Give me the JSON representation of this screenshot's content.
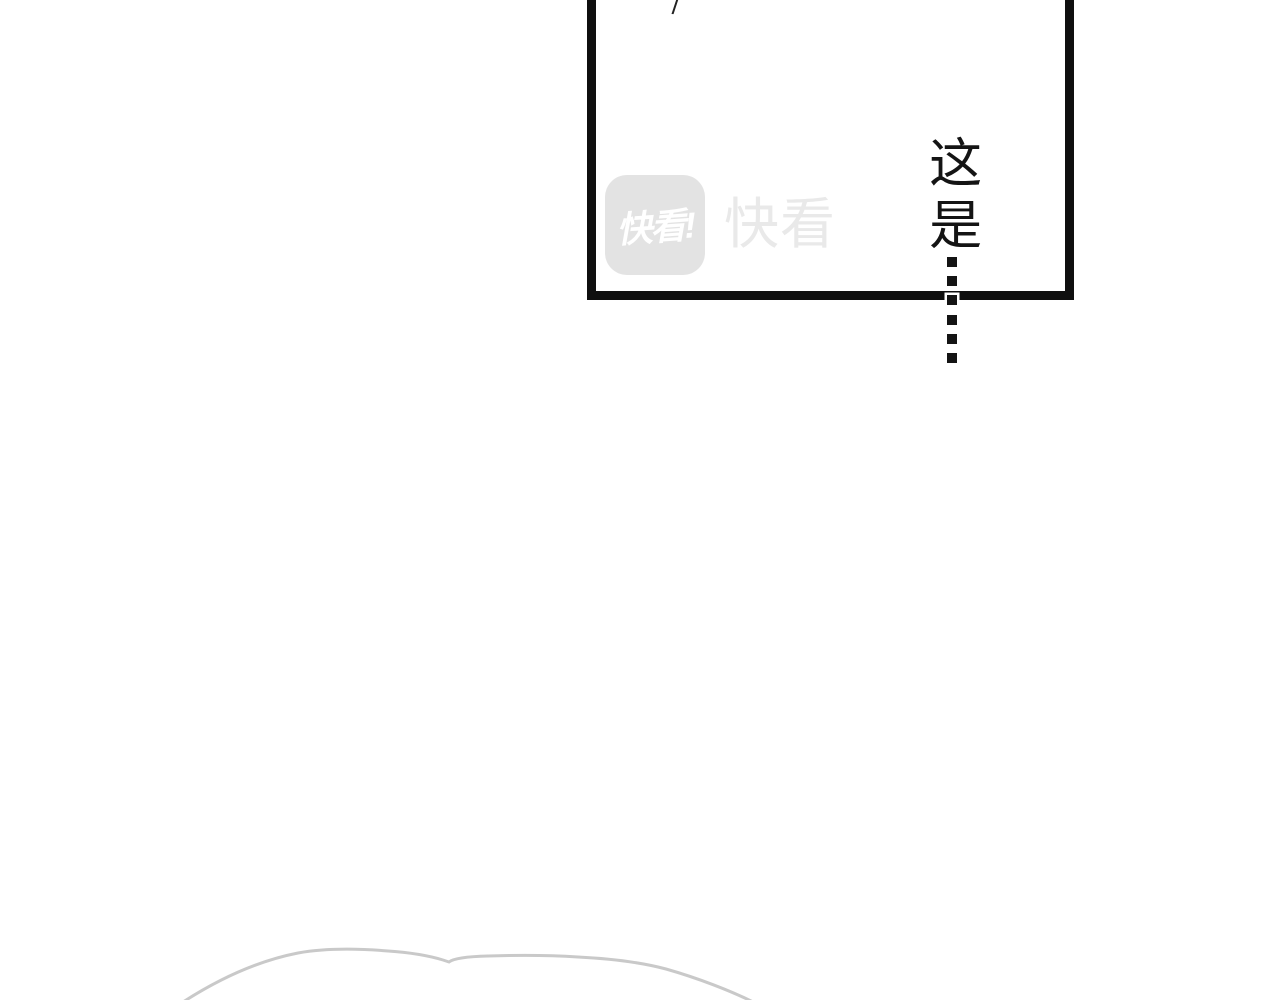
{
  "page": {
    "type": "comic-panel-page",
    "background": "#ffffff"
  },
  "panel": {
    "slash_mark": "/",
    "border_color": "#0f0f0f"
  },
  "watermark": {
    "logo_text": "快看!",
    "brand_text": "快看",
    "logo_badge_color": "#e3e3e3",
    "logo_text_color": "#ffffff",
    "brand_text_color": "#e9e9e9"
  },
  "speech": {
    "vertical_text": "这是",
    "text_color": "#141414"
  },
  "dotted_line": {
    "dash_count": 6,
    "dash_color": "#141414",
    "halo_color": "#ffffff"
  },
  "decor": {
    "curve_color": "#c9c9c9"
  },
  "colors": {
    "ink": "#0f0f0f",
    "page_background": "#ffffff",
    "logo_badge_gray": "#e3e3e3",
    "logo_text_white": "#ffffff",
    "brand_text_gray": "#e9e9e9",
    "curve_gray": "#c9c9c9",
    "speech_ink": "#141414"
  }
}
